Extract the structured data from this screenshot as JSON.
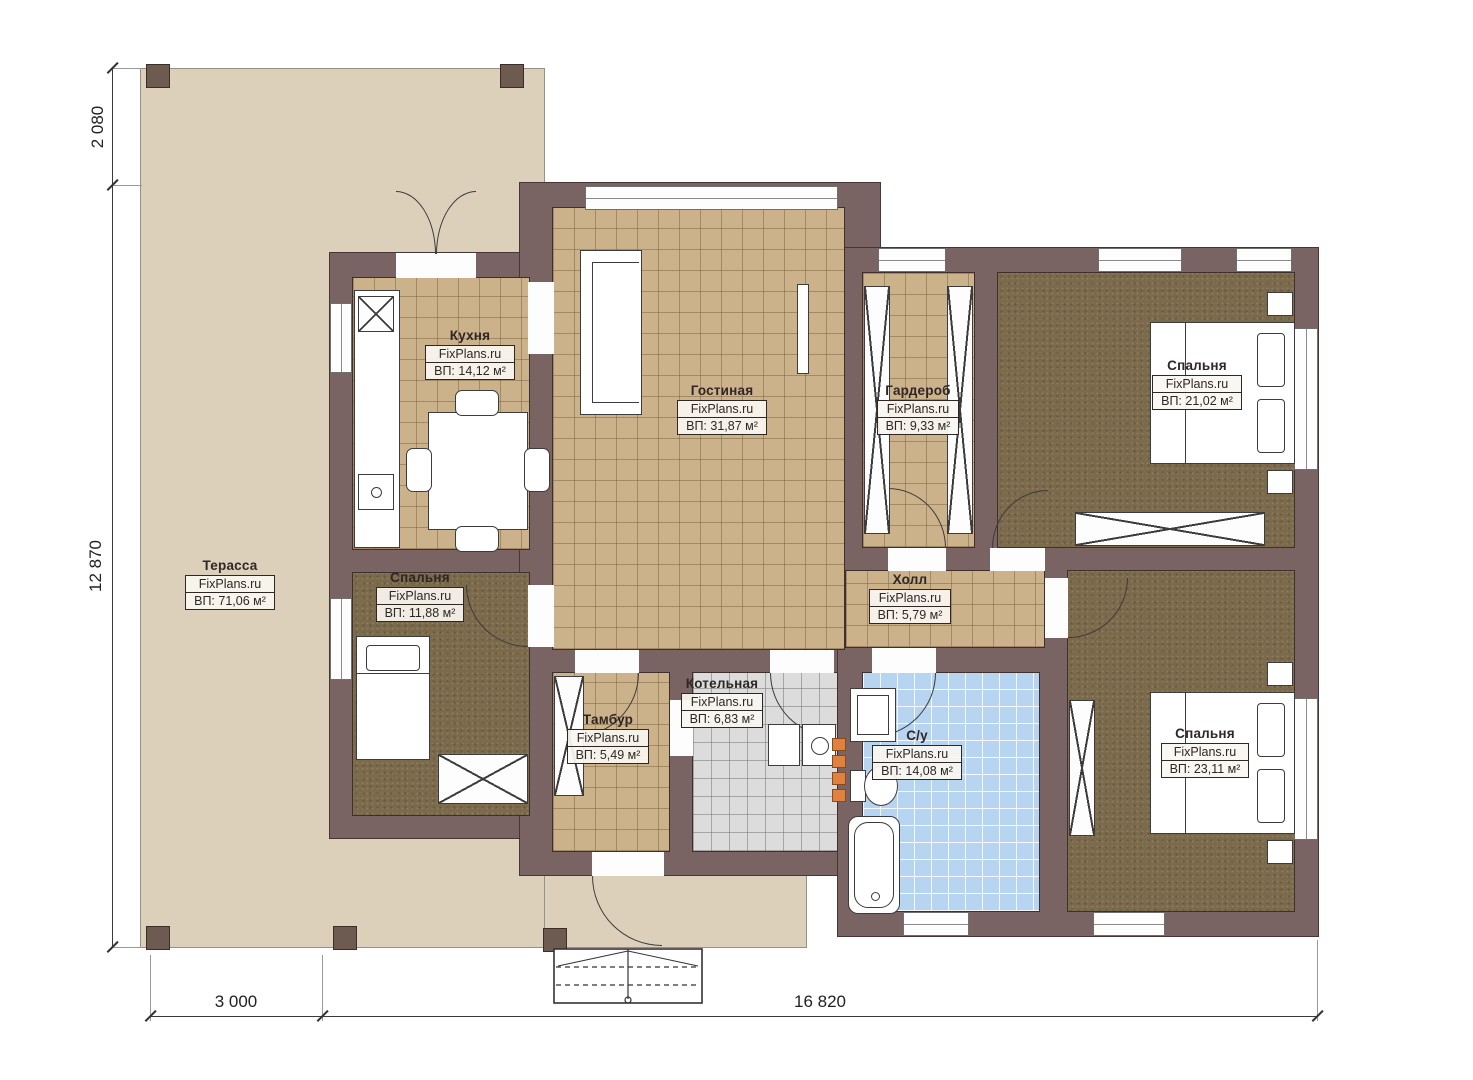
{
  "watermark": "FixPlans.ru",
  "rooms": {
    "terrace": {
      "name": "Терасса",
      "brand": "FixPlans.ru",
      "area": "ВП: 71,06 м²"
    },
    "kitchen": {
      "name": "Кухня",
      "brand": "FixPlans.ru",
      "area": "ВП: 14,12 м²"
    },
    "living": {
      "name": "Гостиная",
      "brand": "FixPlans.ru",
      "area": "ВП: 31,87 м²"
    },
    "wardrobe": {
      "name": "Гардероб",
      "brand": "FixPlans.ru",
      "area": "ВП: 9,33 м²"
    },
    "bedroom_tr": {
      "name": "Спальня",
      "brand": "FixPlans.ru",
      "area": "ВП: 21,02 м²"
    },
    "bedroom_left": {
      "name": "Спальня",
      "brand": "FixPlans.ru",
      "area": "ВП: 11,88 м²"
    },
    "hall": {
      "name": "Холл",
      "brand": "FixPlans.ru",
      "area": "ВП: 5,79 м²"
    },
    "vestibule": {
      "name": "Тамбур",
      "brand": "FixPlans.ru",
      "area": "ВП: 5,49 м²"
    },
    "boiler": {
      "name": "Котельная",
      "brand": "FixPlans.ru",
      "area": "ВП: 6,83 м²"
    },
    "bathroom": {
      "name": "С/у",
      "brand": "FixPlans.ru",
      "area": "ВП: 14,08 м²"
    },
    "bedroom_br": {
      "name": "Спальня",
      "brand": "FixPlans.ru",
      "area": "ВП: 23,11 м²"
    }
  },
  "dimensions": {
    "terrace_depth": "2 080",
    "house_height": "12 870",
    "terrace_width": "3 000",
    "house_width": "16 820"
  },
  "colors": {
    "wall": "#7a6363",
    "terrace": "#ddd0bb",
    "tile_tan": "#ccb28a",
    "carpet": "#7b6a4c",
    "tile_gray": "#dcdcdc",
    "tile_blue": "#b7d4f1",
    "accent_orange": "#e0813f"
  }
}
